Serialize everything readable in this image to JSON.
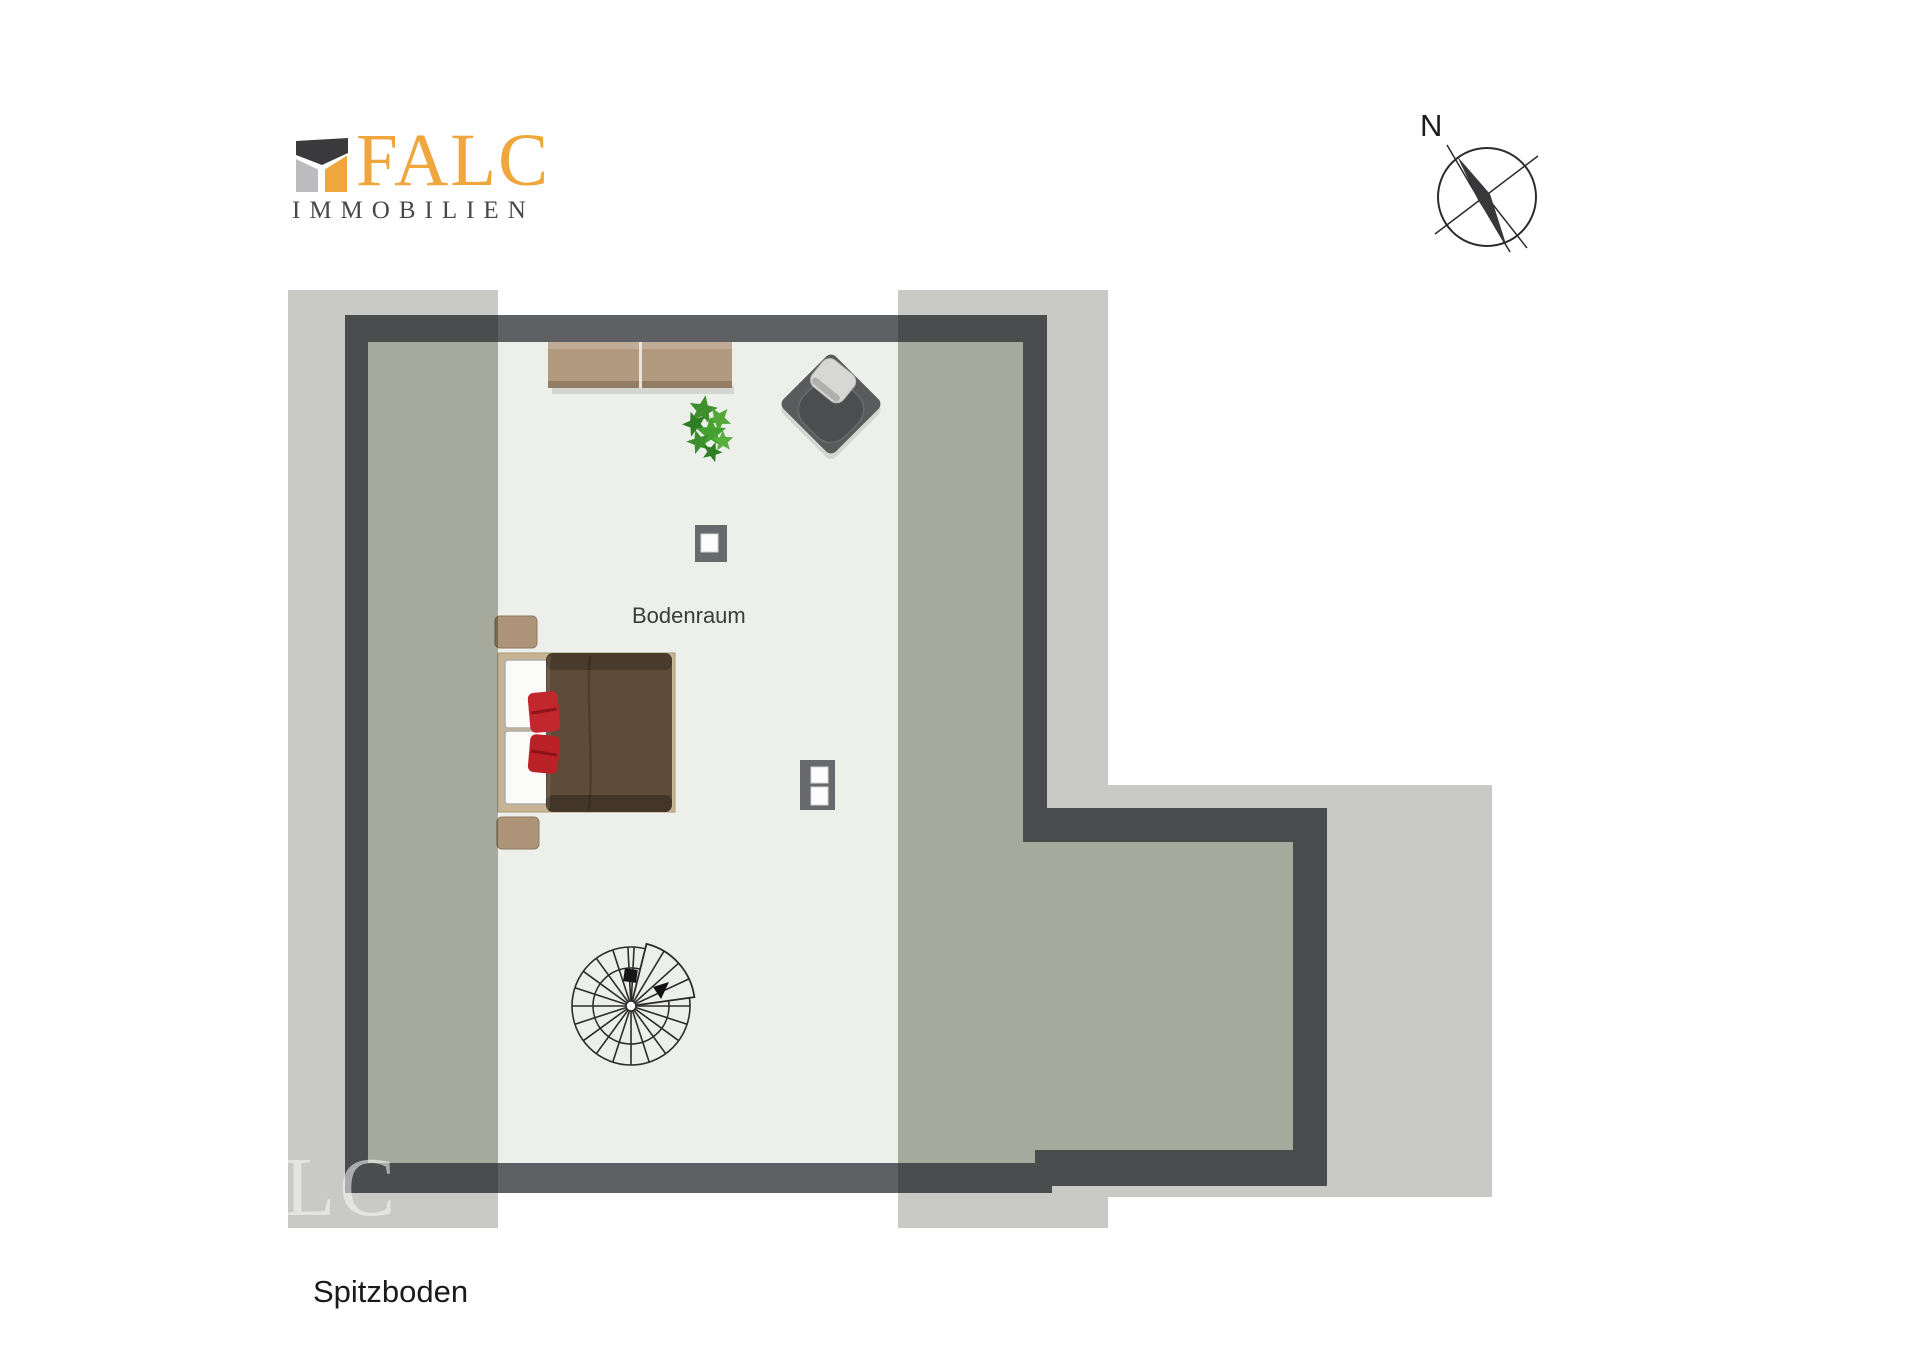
{
  "logo": {
    "wordmark": "FALC",
    "subtitle": "IMMOBILIEN",
    "icon": "falc-house-icon",
    "colors": {
      "orange": "#EFA63C",
      "dark": "#3A3A3C",
      "gray": "#BCBCBE"
    }
  },
  "compass": {
    "north_label": "N",
    "icon": "compass-rose-icon"
  },
  "labels": {
    "room": "Bodenraum",
    "floor_title": "Spitzboden",
    "watermark": "LC"
  },
  "colors": {
    "background": "#FFFFFF",
    "wall": "#5E6064",
    "floor": "#EDEFEA",
    "roof_overlay": "#C9CAC6",
    "roof_overlay_floor_tint": "#E2E5DE",
    "wood_sideboard": "#B29A81",
    "wood_nightstand": "#AD9479",
    "bed_frame": "#C8B493",
    "mattress": "#FBFBFA",
    "duvet": "#5E4B39",
    "pillow_red": "#C2272E",
    "armchair": "#5A5B5D",
    "armchair_seat": "#4C4D4F",
    "armchair_cushion": "#D7D7D5",
    "chimney": "#68696C",
    "plant_green": "#46A02F",
    "stair_stroke": "#2C2C2C"
  }
}
